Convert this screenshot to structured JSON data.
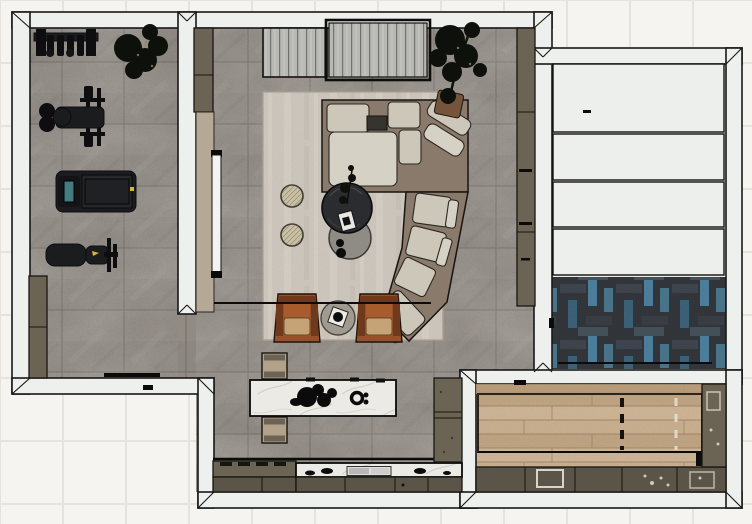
{
  "app": {
    "description": "Top-down 3D rendered interior floor plan"
  },
  "palette": {
    "ext": "#f5f4f1",
    "extLine": "#e5e3de",
    "wall": "#eef0ee",
    "wallLine": "#181818",
    "stone": "#8d8781",
    "stoneHi": "#99948d",
    "stoneLine": "#6f6b65",
    "rug": "#cfc8bf",
    "rugHi": "#ddd7cd",
    "rugLine": "#aaa296",
    "olive": "#6b6455",
    "oliveDark": "#5b5549",
    "oliveLine": "#181510",
    "tan": "#b6a896",
    "marble": "#eceae5",
    "marbleVein": "#b9b6af",
    "wood": "#c7ae8d",
    "woodHi": "#d2bb9c",
    "woodLo": "#bca180",
    "woodSeam": "#9a8161",
    "woodBorder": "#b49878",
    "woodFrame": "#2a241b",
    "herrBase": "#34383d",
    "herrHi": "#404750",
    "herrBlue": "#4f82a0",
    "herrBlue2": "#3d657c",
    "sofaBase": "#8a7a6c",
    "cushion": "#cdc7ba",
    "cushionHi": "#d6d1c5",
    "cushionLine": "#2b2822",
    "chair": "#97512a",
    "chairDark": "#6f391c",
    "chairInner": "#a85c2e",
    "chairSeat": "#c5a377",
    "tableDark": "#2b2c2f",
    "tableGray": "#8f8c86",
    "pouf": "#c9c0a6",
    "poufLine": "#7c7454",
    "plant": "#0e110b",
    "plantSpeck": "#6a7a36",
    "pot": "#75543c",
    "equip": "#1b1c1e",
    "equipDark": "#0e0e10",
    "screen": "#417c82",
    "yellow": "#d9b33c",
    "tv": "#f3f3f1",
    "black": "#0b0b0b",
    "panel": "#edefec",
    "benchTan": "#b2a289",
    "benchBand": "#6d6354"
  },
  "rooms": [
    {
      "id": "gym",
      "furniture": [
        "dumbbell-rack",
        "potted-plant",
        "smith-machine",
        "treadmill",
        "workout-bench",
        "storage-cabinet"
      ]
    },
    {
      "id": "living-room",
      "furniture": [
        "fluted-sideboard",
        "fluted-sideboard",
        "wall-cabinet",
        "tall-cabinet",
        "tv-panel",
        "area-rug",
        "sectional-sofa",
        "corner-chaise",
        "pouf",
        "pouf",
        "round-coffee-table",
        "round-side-table",
        "leather-armchair",
        "leather-armchair",
        "between-chairs-table",
        "potted-tree"
      ]
    },
    {
      "id": "kitchen",
      "furniture": [
        "marble-island",
        "island-bench",
        "island-bench",
        "cooktop-counter",
        "marble-counter",
        "base-cabinets",
        "tall-cabinets"
      ]
    },
    {
      "id": "garage",
      "furniture": [
        "sectional-door-panels",
        "herringbone-tile-floor"
      ]
    },
    {
      "id": "rec-room",
      "furniture": [
        "wood-lane-floor",
        "lane-marking-dashed",
        "storage-cabinets",
        "side-cabinets"
      ]
    }
  ]
}
